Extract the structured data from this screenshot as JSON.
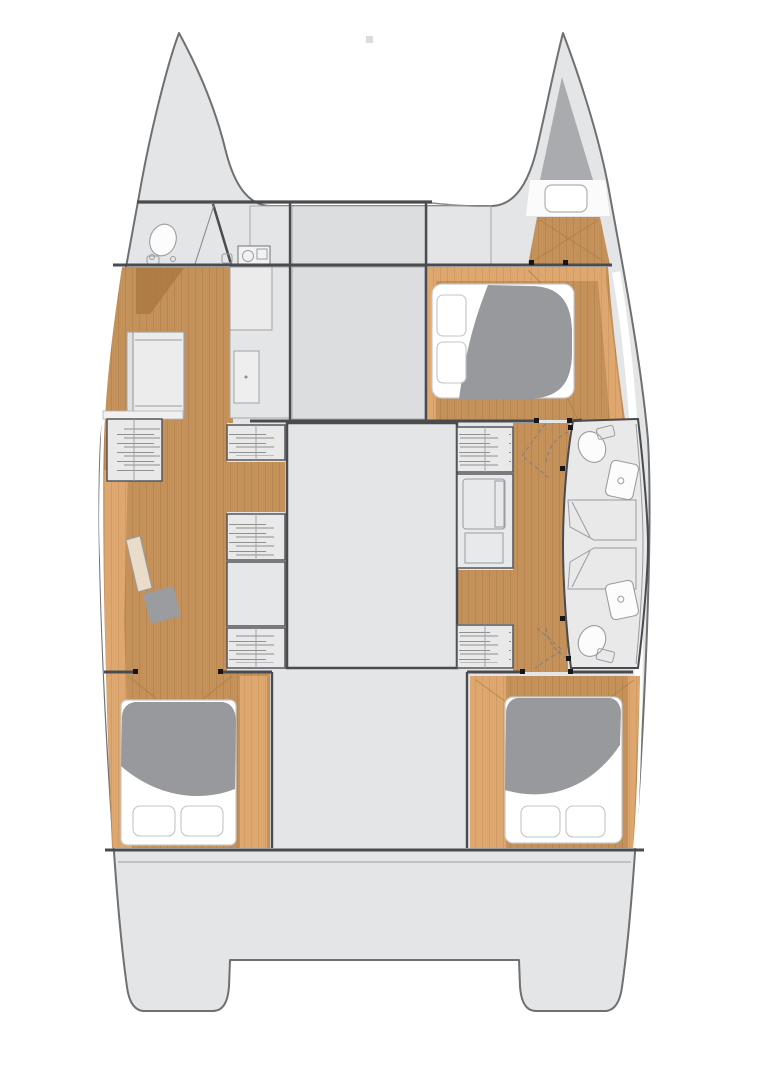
{
  "figure": {
    "kind": "catamaran-interior-floor-plan",
    "orientation": "bow-up",
    "double_berths": 3,
    "sofa_berths": 1,
    "toilets": 3,
    "washbasins": 3,
    "showers": 2,
    "companionway_steps": 6,
    "deck_hatches": 1
  },
  "palette": {
    "deck": "#e4e5e6",
    "deck-dark": "#dcdddf",
    "panel": "#e9e9ea",
    "outline": "#6f7072",
    "wall": "#4a4b4e",
    "thin": "#9b9da0",
    "wood": "#c4915a",
    "wood-line": "#a87a42",
    "wood-light": "#dda76f",
    "wood-light-line": "#c08d52",
    "wood-dark": "#b07c45",
    "duvet": "#97999c",
    "darkgray": "#a9abae",
    "seat": "#9a9c9f",
    "white": "#ffffff",
    "fixture": "#9a9ca0",
    "mark": "#161616",
    "tread": "#8e9092"
  },
  "features": [
    {
      "name": "port-bow",
      "items": [
        "forward-head-toilet",
        "washbasin-unit",
        "door-diagonal-wall"
      ]
    },
    {
      "name": "starboard-bow",
      "items": [
        "bow-locker-triangle",
        "deck-hatch",
        "forepeak-wood-floor"
      ]
    },
    {
      "name": "foredeck-lockers",
      "items": [
        "locker-panel",
        "locker-panel",
        "locker-panel",
        "deck-fitting-mark"
      ]
    },
    {
      "name": "port-hull",
      "items": [
        "wood-corridor",
        "sofa-berth",
        "tall-locker",
        "cabinet",
        "companionway-steps",
        "companionway-steps",
        "companionway-steps",
        "companionway-steps",
        "desk-panel",
        "seat-stool",
        "double-bed",
        "pillows",
        "duvet"
      ]
    },
    {
      "name": "saloon",
      "items": [
        "forward-saloon-panel",
        "main-saloon-deck"
      ]
    },
    {
      "name": "starboard-hull",
      "items": [
        "double-bed-forward",
        "pillows",
        "duvet",
        "companionway-steps",
        "companionway-steps",
        "galley-counter",
        "bathroom-block",
        "toilet",
        "toilet",
        "washbasin",
        "washbasin",
        "shower",
        "shower",
        "door-swing-dashes",
        "double-bed-aft",
        "wood-corridor"
      ]
    },
    {
      "name": "aft-section",
      "items": [
        "aft-corridor",
        "aft-deck",
        "transom-step-port",
        "transom-step-starboard",
        "hinge-marks"
      ]
    }
  ]
}
